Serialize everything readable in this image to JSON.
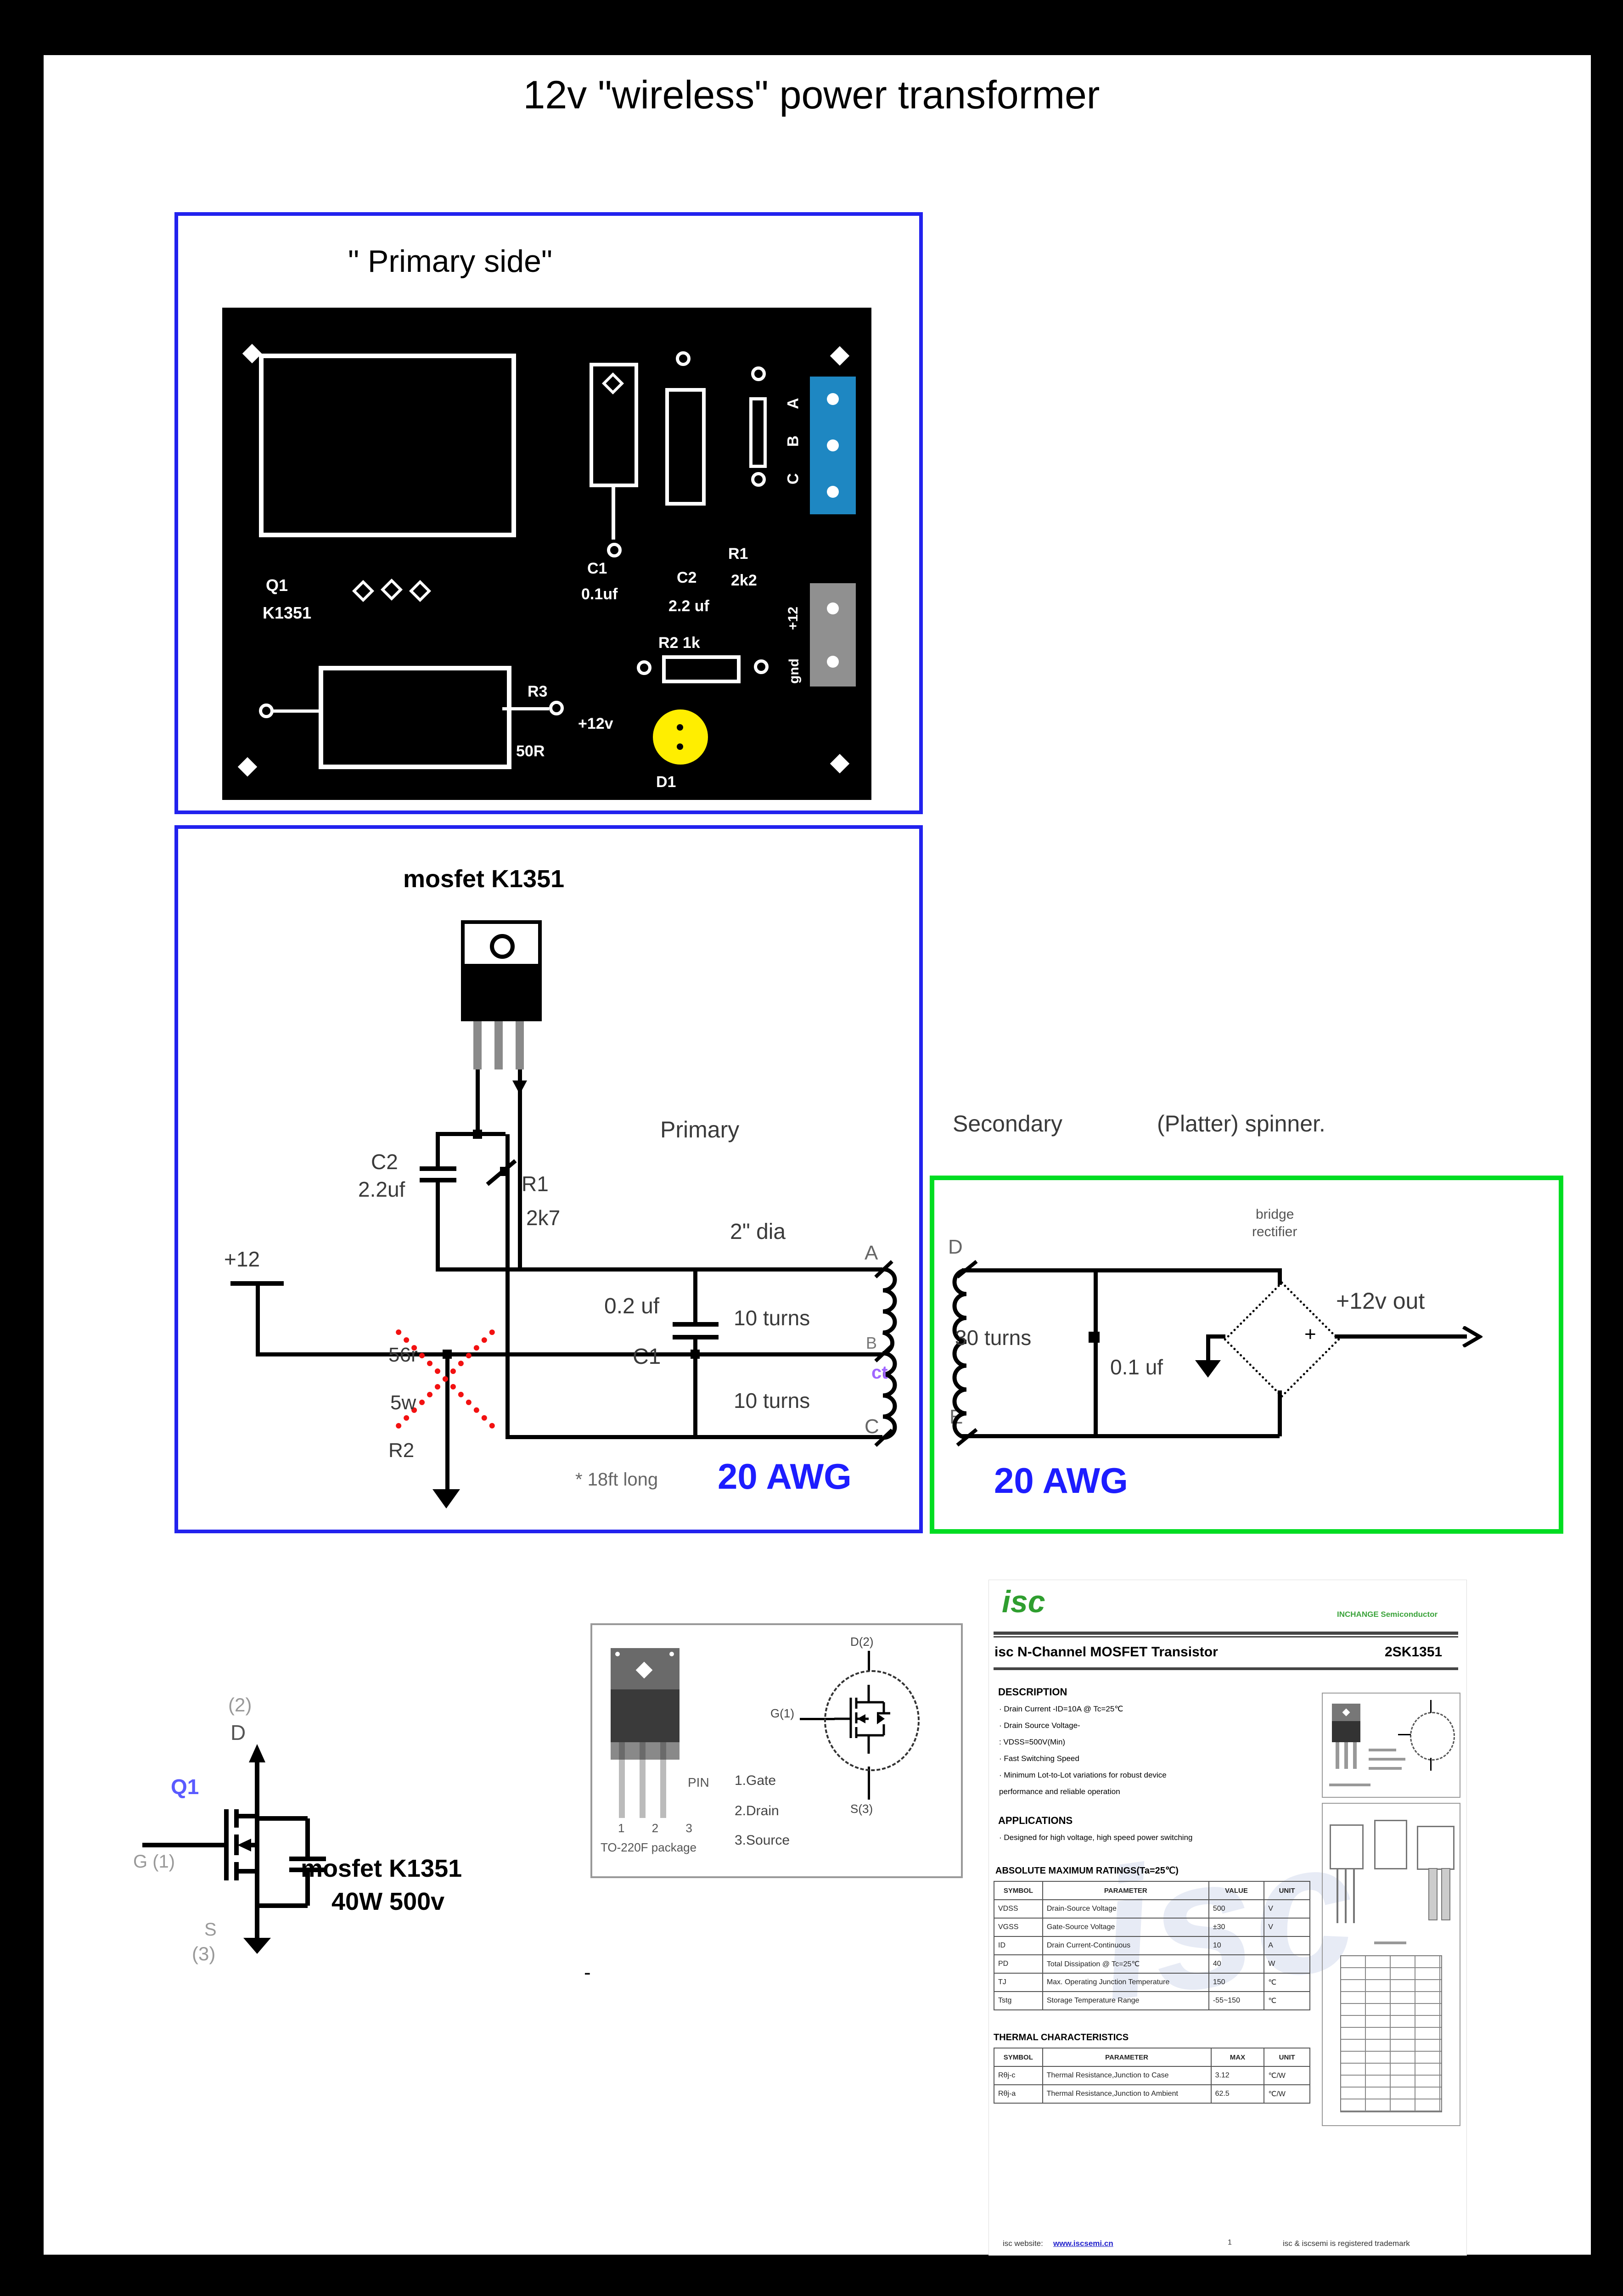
{
  "page": {
    "title": "12v \"wireless\" power transformer"
  },
  "primary_board": {
    "caption": "\" Primary side\"",
    "pcb": {
      "q1": "Q1",
      "q1_part": "K1351",
      "c1": "C1",
      "c1_val": "0.1uf",
      "c2": "C2",
      "c2_val": "2.2 uf",
      "r1": "R1",
      "r1_val": "2k2",
      "r2": "R2 1k",
      "r3": "R3",
      "r3_val": "50R",
      "supply": "+12v",
      "d1": "D1",
      "conn_abc": [
        "A",
        "B",
        "C"
      ],
      "conn_pwr": [
        "+12",
        "gnd"
      ]
    }
  },
  "schematic": {
    "title": "mosfet K1351",
    "c2": {
      "ref": "C2",
      "value": "2.2uf"
    },
    "r1": {
      "ref": "R1",
      "value": "2k7"
    },
    "supply": "+12",
    "r2": {
      "value": "56r",
      "power": "5w",
      "ref": "R2"
    },
    "section": "Primary",
    "coil_dia": "2\" dia",
    "c1": {
      "value": "0.2 uf",
      "ref": "C1"
    },
    "turns_top": "10 turns",
    "turns_bottom": "10 turns",
    "terminals": {
      "a": "A",
      "b": "B",
      "c": "C",
      "ct": "ct"
    },
    "length_note": "* 18ft long",
    "gauge": "20 AWG"
  },
  "secondary": {
    "section": "Secondary",
    "section2": "(Platter) spinner.",
    "terminals": {
      "d": "D",
      "e": "E"
    },
    "turns": "30 turns",
    "cap": "0.1 uf",
    "bridge_line1": "bridge",
    "bridge_line2": "rectifier",
    "plus": "+",
    "out": "+12v out",
    "gauge": "20 AWG"
  },
  "mosfet_detail": {
    "pin2": "(2)",
    "d": "D",
    "ref": "Q1",
    "g": "G (1)",
    "s": "S",
    "pin3": "(3)",
    "name": "mosfet K1351",
    "rating": "40W 500v",
    "dash": "-"
  },
  "pinout": {
    "pin": "PIN",
    "pin1": "1.Gate",
    "pin2": "2.Drain",
    "pin3": "3.Source",
    "legs": "1 2 3",
    "package": "TO-220F package",
    "d": "D(2)",
    "g": "G(1)",
    "s": "S(3)"
  },
  "datasheet": {
    "logo": "isc",
    "brand": "INCHANGE Semiconductor",
    "product_line": "isc N-Channel MOSFET Transistor",
    "part_number": "2SK1351",
    "description_title": "DESCRIPTION",
    "description_items": [
      "· Drain Current -ID=10A @ Tc=25℃",
      "· Drain Source Voltage-",
      "   : VDSS=500V(Min)",
      "· Fast Switching Speed",
      "· Minimum Lot-to-Lot variations for robust device",
      "   performance and reliable operation"
    ],
    "applications_title": "APPLICATIONS",
    "applications_item": "· Designed for high voltage, high speed power switching",
    "ratings_title": "ABSOLUTE MAXIMUM RATINGS(Ta=25℃)",
    "ratings_headers": [
      "SYMBOL",
      "PARAMETER",
      "VALUE",
      "UNIT"
    ],
    "ratings_rows": [
      [
        "VDSS",
        "Drain-Source Voltage",
        "500",
        "V"
      ],
      [
        "VGSS",
        "Gate-Source Voltage",
        "±30",
        "V"
      ],
      [
        "ID",
        "Drain Current-Continuous",
        "10",
        "A"
      ],
      [
        "PD",
        "Total Dissipation @ Tc=25℃",
        "40",
        "W"
      ],
      [
        "TJ",
        "Max. Operating Junction Temperature",
        "150",
        "℃"
      ],
      [
        "Tstg",
        "Storage Temperature Range",
        "-55~150",
        "℃"
      ]
    ],
    "thermal_title": "THERMAL CHARACTERISTICS",
    "thermal_headers": [
      "SYMBOL",
      "PARAMETER",
      "MAX",
      "UNIT"
    ],
    "thermal_rows": [
      [
        "Rθj-c",
        "Thermal Resistance,Junction to Case",
        "3.12",
        "℃/W"
      ],
      [
        "Rθj-a",
        "Thermal Resistance,Junction to Ambient",
        "62.5",
        "℃/W"
      ]
    ],
    "footer_left": "isc website:",
    "footer_link": "www.iscsemi.cn",
    "footer_page": "1",
    "footer_right": "isc & iscsemi is registered trademark"
  },
  "colors": {
    "box_blue": "#2222ee",
    "box_green": "#00dd22",
    "gauge_blue": "#1d1dff",
    "ct_purple": "#a066ff",
    "q1_violet": "#5a5aff",
    "led_yellow": "#ffee00",
    "connector_blue": "#1e87c2",
    "connector_gray": "#909090",
    "isc_green": "#2f9e2f"
  }
}
